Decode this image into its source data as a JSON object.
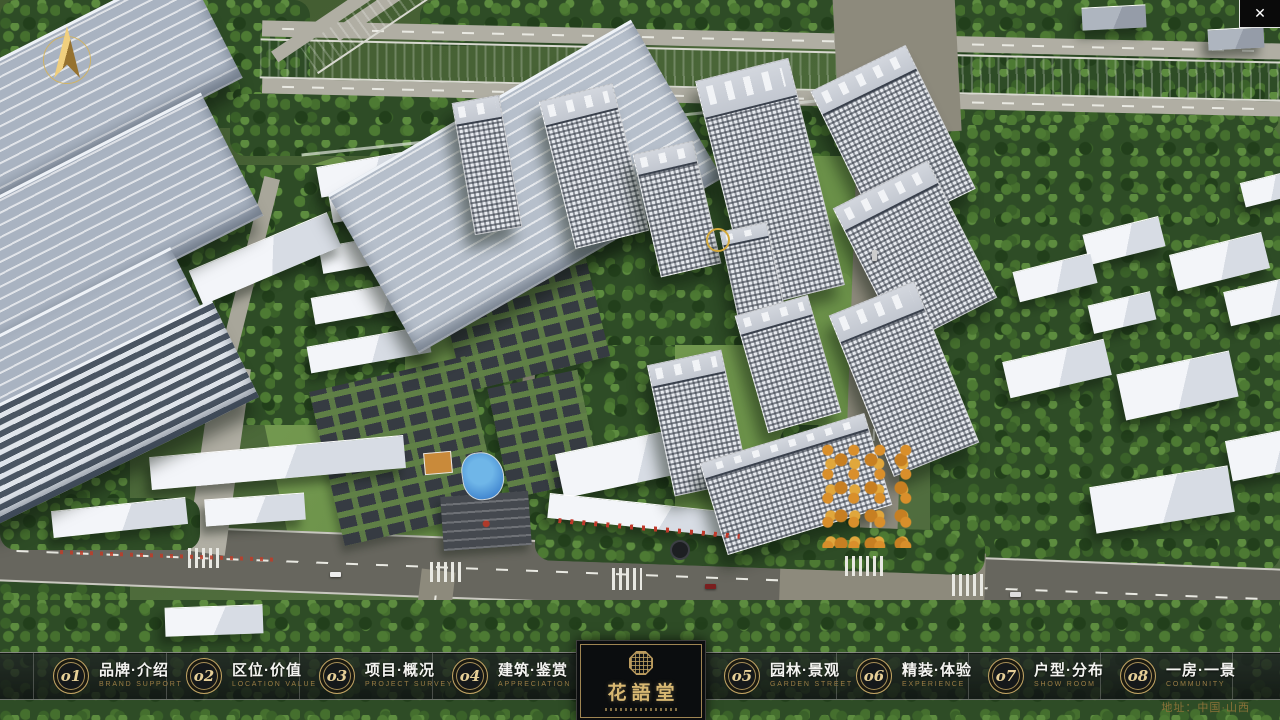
{
  "window": {
    "close_icon": "✕"
  },
  "nav": {
    "items": [
      {
        "num": "o1",
        "zh": "品牌·介绍",
        "en": "BRAND SUPPORT"
      },
      {
        "num": "o2",
        "zh": "区位·价值",
        "en": "LOCATION VALUE"
      },
      {
        "num": "o3",
        "zh": "项目·概况",
        "en": "PROJECT SURVEY"
      },
      {
        "num": "o4",
        "zh": "建筑·鉴赏",
        "en": "APPRECIATION"
      },
      {
        "num": "o5",
        "zh": "园林·景观",
        "en": "GARDEN STREET"
      },
      {
        "num": "o6",
        "zh": "精装·体验",
        "en": "EXPERIENCE"
      },
      {
        "num": "o7",
        "zh": "户型·分布",
        "en": "SHOW ROOM"
      },
      {
        "num": "o8",
        "zh": "一房·一景",
        "en": "COMMUNITY"
      }
    ]
  },
  "logo": {
    "title": "花語堂"
  },
  "footer": {
    "address": "地址：中国·山西"
  },
  "colors": {
    "gold": "#c2a463",
    "river": "#2f63d6",
    "road_dark": "#67665e",
    "road_light": "#8d8a7c",
    "tree_green": "#2e4c26"
  }
}
